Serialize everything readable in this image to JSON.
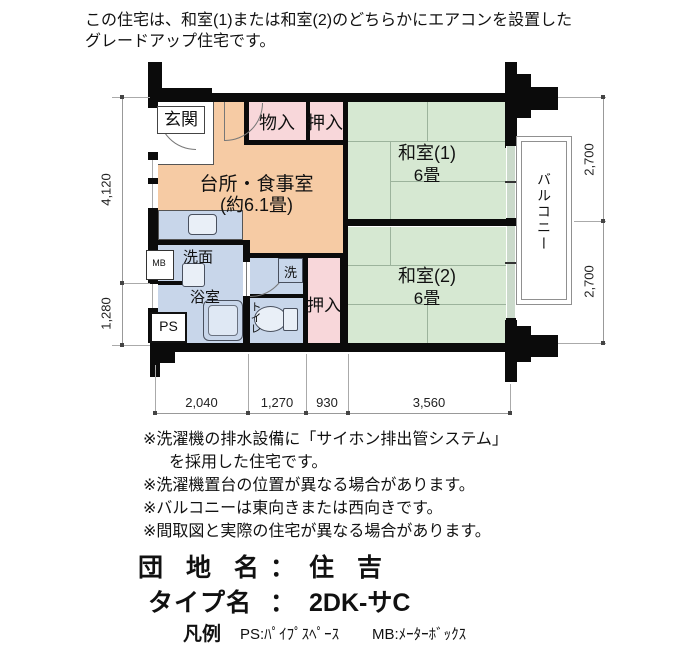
{
  "header": {
    "line1": "この住宅は、和室(1)または和室(2)のどちらかにエアコンを設置した",
    "line2": "グレードアップ住宅です。"
  },
  "plan": {
    "rooms": {
      "genkan": "玄関",
      "monoire": "物入",
      "oshiire_top": "押入",
      "kitchen_name": "台所・食事室",
      "kitchen_size": "(約6.1畳)",
      "washitsu1_name": "和室(1)",
      "washitsu1_size": "6畳",
      "washitsu2_name": "和室(2)",
      "washitsu2_size": "6畳",
      "senmen": "洗面",
      "yokushitsu": "浴室",
      "washer": "洗",
      "toilet": "トイレ",
      "oshiire_bottom": "押入",
      "balcony": "バルコニー",
      "ps": "PS",
      "mb": "MB"
    },
    "dims": {
      "left_top": "4,120",
      "left_bottom": "1,280",
      "right_top": "2,700",
      "right_bottom": "2,700",
      "bottom_1": "2,040",
      "bottom_2": "1,270",
      "bottom_3": "930",
      "bottom_4": "3,560"
    }
  },
  "notes": {
    "line1": "※洗濯機の排水設備に「サイホン排出管システム」",
    "line2": "を採用した住宅です。",
    "line3": "※洗濯機置台の位置が異なる場合があります。",
    "line4": "※バルコニーは東向きまたは西向きです。",
    "line5": "※間取図と実際の住宅が異なる場合があります。"
  },
  "footer": {
    "estate_label": "団 地 名",
    "estate_sep": "：",
    "estate_value": "住 吉",
    "type_label": "タイプ名",
    "type_sep": "：",
    "type_value": "2DK-サC",
    "legend_title": "凡例",
    "legend_ps": "PS:ﾊﾟｲﾌﾟｽﾍﾟｰｽ",
    "legend_mb": "MB:ﾒｰﾀｰﾎﾞｯｸｽ"
  },
  "colors": {
    "kitchen": "#F6CBA4",
    "closet": "#F8D7DA",
    "tatami": "#D6E8D2",
    "wet": "#C8D6EA",
    "window": "#CBDACB",
    "wall": "#0B0B0B",
    "dim_line": "#999999"
  }
}
